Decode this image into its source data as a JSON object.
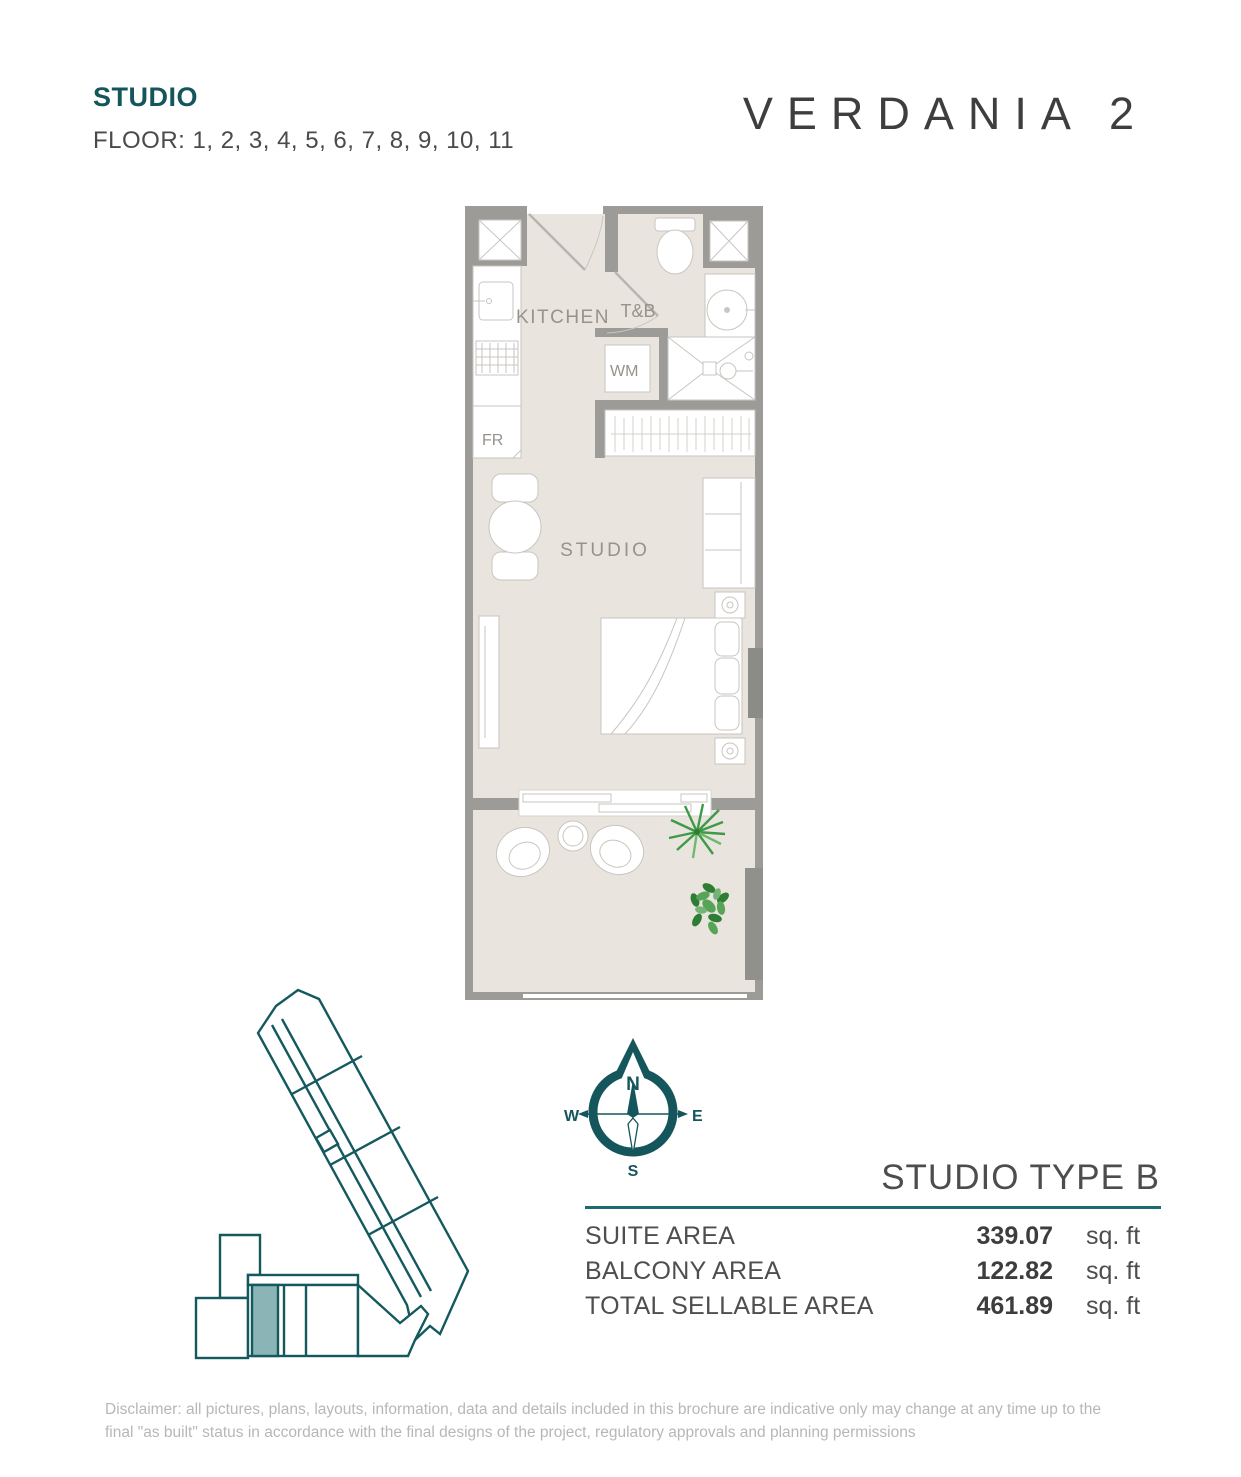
{
  "header": {
    "unit_type": "STUDIO",
    "floors": "FLOOR: 1, 2, 3, 4, 5, 6, 7, 8, 9, 10, 11"
  },
  "brand": {
    "name": "VERDANIA 2"
  },
  "floor_plan": {
    "labels": {
      "kitchen": "KITCHEN",
      "toilet_bath": "T&B",
      "washing_machine": "WM",
      "fridge": "FR",
      "studio": "STUDIO"
    }
  },
  "compass": {
    "north": "N",
    "south": "S",
    "east": "E",
    "west": "W"
  },
  "unit_info": {
    "title": "STUDIO TYPE B",
    "rows": [
      {
        "label": "SUITE AREA",
        "value": "339.07",
        "unit": "sq. ft"
      },
      {
        "label": "BALCONY AREA",
        "value": "122.82",
        "unit": "sq. ft"
      },
      {
        "label": "TOTAL SELLABLE AREA",
        "value": "461.89",
        "unit": "sq. ft"
      }
    ]
  },
  "key_plan": {
    "description": "building footprint with highlighted unit",
    "outline_color": "#14595e",
    "highlight_color": "#8ab4b6"
  },
  "colors": {
    "accent_teal": "#15565c",
    "rule_teal": "#1d6b70",
    "wall_gray": "#9c9b97",
    "floor_beige": "#eae4de",
    "plant_green": "#3f9a45"
  },
  "disclaimer": "Disclaimer: all pictures, plans, layouts, information, data and details included in this brochure are indicative only may change at any time up to the final \"as built\" status in accordance with the final designs of the project, regulatory approvals and planning permissions"
}
